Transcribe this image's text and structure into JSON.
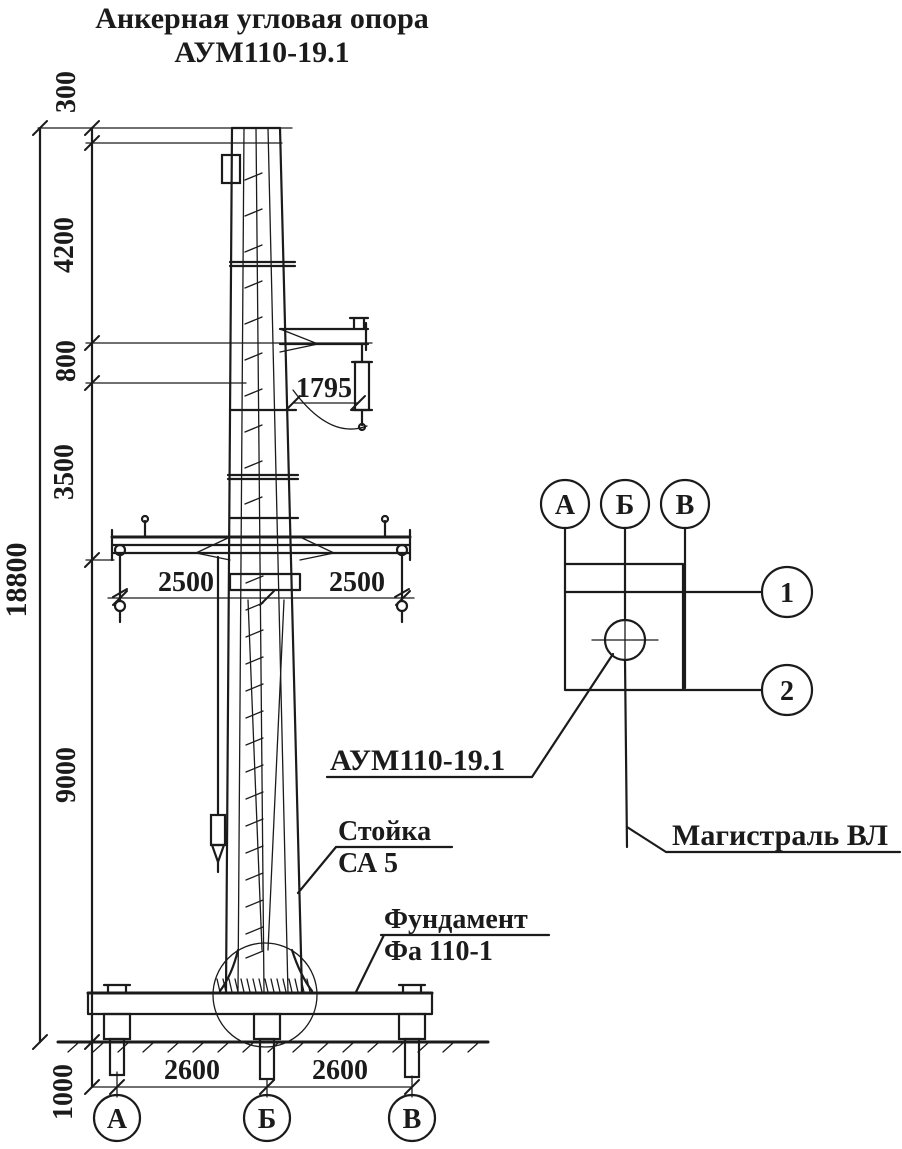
{
  "title": {
    "line1": "Анкерная угловая опора",
    "line2": "АУМ110-19.1"
  },
  "colors": {
    "ink": "#1b1b1b",
    "paper": "#ffffff"
  },
  "elevation": {
    "dims": {
      "total": "18800",
      "top": "300",
      "s4200": "4200",
      "s800": "800",
      "s3500": "3500",
      "s9000": "9000",
      "below_ground": "1000",
      "arm": "1795",
      "trav_left": "2500",
      "trav_right": "2500",
      "base_left": "2600",
      "base_right": "2600"
    },
    "callouts": {
      "stand_title": "Стойка",
      "stand_model": "СА 5",
      "foundation_title": "Фундамент",
      "foundation_model": "Фа 110-1"
    },
    "axes": [
      "А",
      "Б",
      "В"
    ]
  },
  "plan": {
    "column_axes": [
      "А",
      "Б",
      "В"
    ],
    "row_axes": [
      "1",
      "2"
    ],
    "tower_label": "АУМ110-19.1",
    "line_label": "Магистраль ВЛ"
  }
}
